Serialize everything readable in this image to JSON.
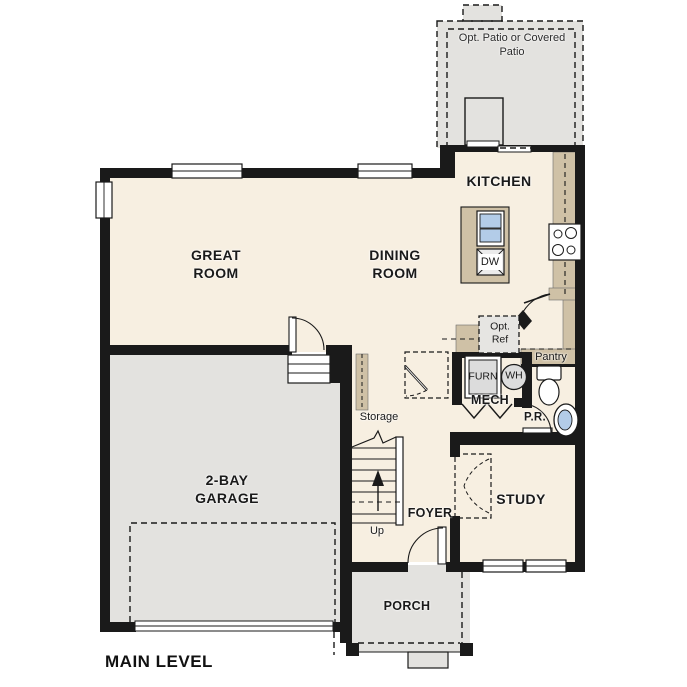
{
  "plan_title": "MAIN LEVEL",
  "labels": {
    "great_room": "GREAT ROOM",
    "dining_room": "DINING ROOM",
    "kitchen": "KITCHEN",
    "garage": "2-BAY GARAGE",
    "study": "STUDY",
    "foyer": "FOYER",
    "porch": "PORCH",
    "patio": "Opt. Patio or Covered Patio",
    "mech": "MECH",
    "powder_room": "P.R.",
    "pantry": "Pantry",
    "storage": "Storage",
    "up": "Up",
    "furnace": "FURN",
    "water_heater": "WH",
    "dishwasher": "DW",
    "opt_ref": "Opt. Ref"
  },
  "colors": {
    "wall": "#1a1a1a",
    "floor": "#f7efe1",
    "exterior_concrete": "#e3e2df",
    "counter": "#cfc1a6",
    "sink_blue": "#b3cce8",
    "appliance_gray": "#dcdcdc"
  }
}
